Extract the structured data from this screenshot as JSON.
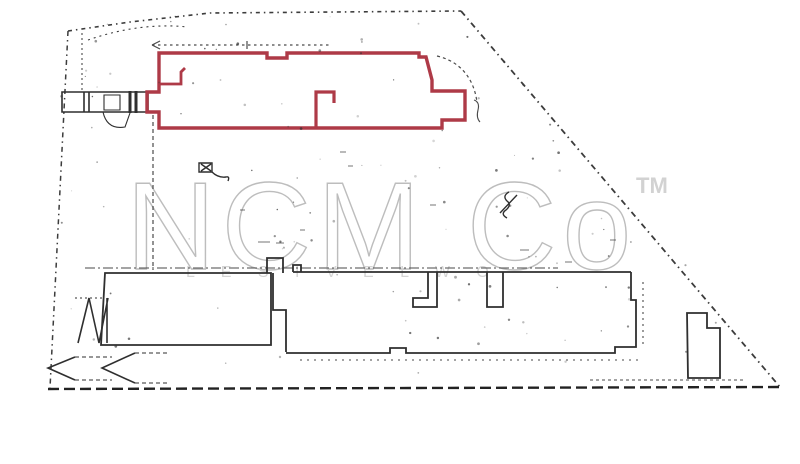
{
  "watermark": {
    "brand": "NCM Co",
    "trademark": "TM",
    "caption_letters": "L E S I V E L W O"
  },
  "plan": {
    "highlighted_building": "red-outlined-building-footprint",
    "site": "scanned-site-plan"
  },
  "colors": {
    "background": "#ffffff",
    "highlight_outline": "#ae3a47",
    "plan_line": "#2f2f2f",
    "boundary_line": "#3c3c3c",
    "watermark_gray": "#bdbdbd",
    "watermark_light": "#d4d4d4"
  }
}
